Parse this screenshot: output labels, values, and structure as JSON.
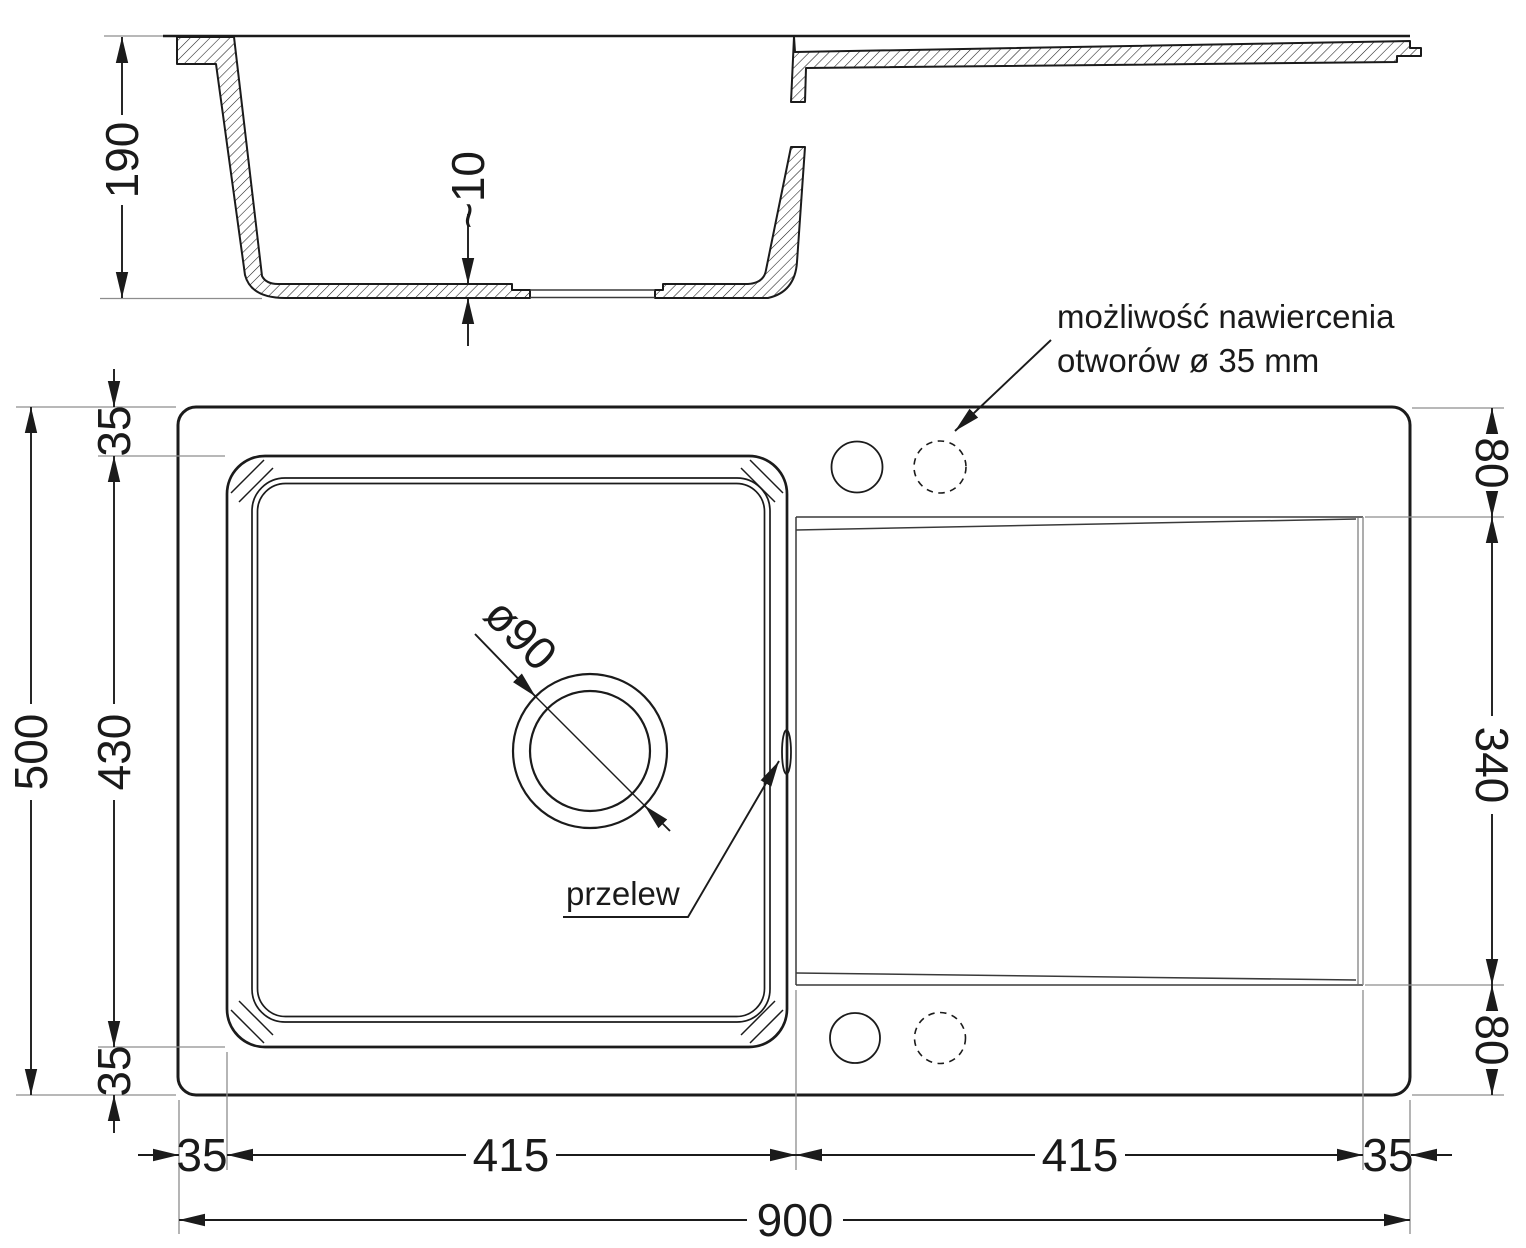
{
  "section_view": {
    "height_label": "190",
    "bottom_thickness_label": "~10"
  },
  "plan_view": {
    "left_dims": {
      "total": "500",
      "basin_depth": "430",
      "top_margin": "35",
      "bottom_margin": "35"
    },
    "right_dims": {
      "top_offset": "80",
      "drainer_span": "340",
      "bottom_offset": "80"
    },
    "bottom_dims": {
      "left_margin": "35",
      "basin_width": "415",
      "drainer_width": "415",
      "right_margin": "35",
      "total_width": "900"
    },
    "drain_label": "ø90",
    "overflow_label": "przelew",
    "note": {
      "line1": "możliwość nawiercenia",
      "line2": "otworów ø 35 mm"
    }
  },
  "colors": {
    "line": "#1b1b1b",
    "thin_line": "#8d8d8d",
    "background": "#ffffff"
  }
}
